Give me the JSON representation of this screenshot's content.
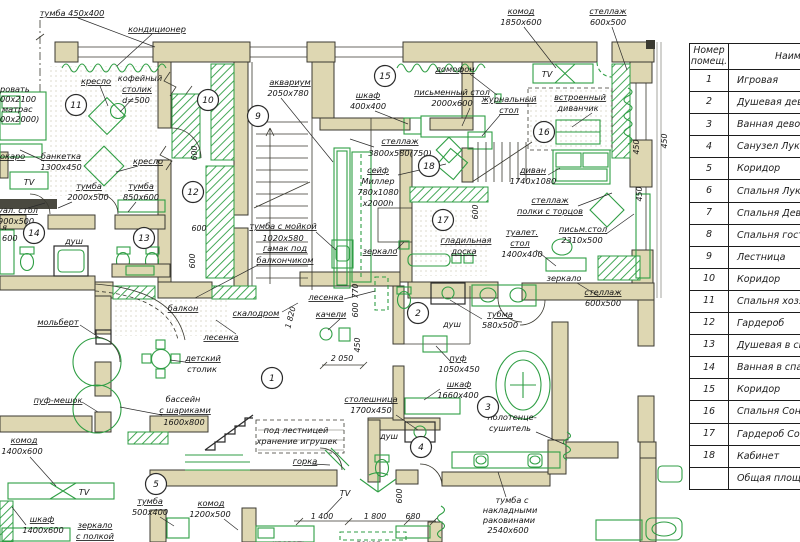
{
  "table": {
    "header1a": "Номер",
    "header1b": "помещ.",
    "header2": "Наименование",
    "rows": [
      {
        "num": "1",
        "name": "Игровая"
      },
      {
        "num": "2",
        "name": "Душевая девочек"
      },
      {
        "num": "3",
        "name": "Ванная девочек"
      },
      {
        "num": "4",
        "name": "Санузел Луки"
      },
      {
        "num": "5",
        "name": "Коридор"
      },
      {
        "num": "6",
        "name": "Спальня Луки"
      },
      {
        "num": "7",
        "name": "Спальня Девочек"
      },
      {
        "num": "8",
        "name": "Спальня гостевая"
      },
      {
        "num": "9",
        "name": "Лестница"
      },
      {
        "num": "10",
        "name": "Коридор"
      },
      {
        "num": "11",
        "name": "Спальня хозяев"
      },
      {
        "num": "12",
        "name": "Гардероб"
      },
      {
        "num": "13",
        "name": "Душевая  в спальне"
      },
      {
        "num": "14",
        "name": "Ванная в спальне"
      },
      {
        "num": "15",
        "name": "Коридор"
      },
      {
        "num": "16",
        "name": "Спальня Сони"
      },
      {
        "num": "17",
        "name": "Гардероб Сони"
      },
      {
        "num": "18",
        "name": "Кабинет"
      },
      {
        "num": "",
        "name": "Общая площадь"
      }
    ]
  },
  "plan": {
    "labels": {
      "tumba450": "тумба 450x400",
      "konditsioner": "кондиционер",
      "komod": "комод",
      "s1850": "1850x600",
      "stell": "стеллаж",
      "s600500": "600x500",
      "kreslo": "кресло",
      "kofeyny": "кофейный",
      "stolik": "столик",
      "d500": "d=500",
      "akvarium": "аквариум",
      "s2050780": "2050x780",
      "shkaf": "шкаф",
      "s400400": "400x400",
      "pismenny_stol": "письменный стол",
      "s2000600": "2000x600",
      "domofon": "домофон",
      "tv": "TV",
      "zhurnalny": "журнальный",
      "stol": "стол",
      "vstroenny": "встроенный",
      "divanchik": "диванчик",
      "s3800": "3800x580(750)",
      "seyf": "сейф",
      "miller": "Миллер",
      "s7801080": "780x1080",
      "s2000h": "x2000h",
      "divan": "диван",
      "s17401080": "1740x1080",
      "polki": "полки с торцов",
      "pism_stol": "письм.стол",
      "s2310500": "2310x500",
      "tualet": "туалет.",
      "s1400400": "1400x400",
      "zerkalo": "зеркало",
      "gladilnaya": "гладильная",
      "doska": "доска",
      "tumba_moykoy": "тумба с мойкой",
      "s1020580": "1020x580",
      "gamak": "гамак под",
      "balkonchikom": "балкончиком",
      "balkon": "балкон",
      "lesenka": "лесенка",
      "skalodrom": "скалодром",
      "kacheli": "качели",
      "detsky": "детский",
      "bassein": "бассейн",
      "sharikami": "с шариками",
      "s1600800": "1600x800",
      "molbert": "мольберт",
      "puf_meshok": "пуф-мешок",
      "s1400600": "1400x600",
      "pod_lestnitsey": "под лестницей",
      "khranenie": "хранение игрушек",
      "gorka": "горка",
      "stoleshnitsa": "столешница",
      "s1700450": "1700x450",
      "tubma": "тубма",
      "s580500": "580x500",
      "puf": "пуф",
      "s1050450": "1050x450",
      "s1660400": "1660x400",
      "polotentse": "полотенце-",
      "sushitel": "сушитель",
      "dush": "душ",
      "banketka": "банкетка",
      "s1300450": "1300x450",
      "tumba": "тумба",
      "s2000500": "2000x500",
      "s850600": "850x600",
      "tual_stol_frag": "уал. стол",
      "s900500": "900x500",
      "frag_ya": "я",
      "frag_600": "600",
      "okaro": "окаро",
      "krov1": "ровать",
      "krov2": "00х2100",
      "krov3": "матрас",
      "krov4": "00х2000)",
      "zerk_polkoy": "с полкой",
      "s500400": "500x400",
      "s1200500": "1200x500",
      "tumba_s": "тумба с",
      "nakladnymi": "накладными",
      "rakovinami": "раковинами",
      "s2540600": "2540x600",
      "krovat": "кровать",
      "dekor": "декор"
    },
    "dims": {
      "d600": "600",
      "d450": "450",
      "d770": "770",
      "d1820": "1 820",
      "d2050": "2 050",
      "d1400": "1 400",
      "d1800": "1 800",
      "d680": "680"
    },
    "rooms": {
      "r1": "1",
      "r2": "2",
      "r3": "3",
      "r4": "4",
      "r5": "5",
      "r9": "9",
      "r10": "10",
      "r11": "11",
      "r12": "12",
      "r13": "13",
      "r14": "14",
      "r15": "15",
      "r16": "16",
      "r17": "17",
      "r18": "18"
    }
  }
}
